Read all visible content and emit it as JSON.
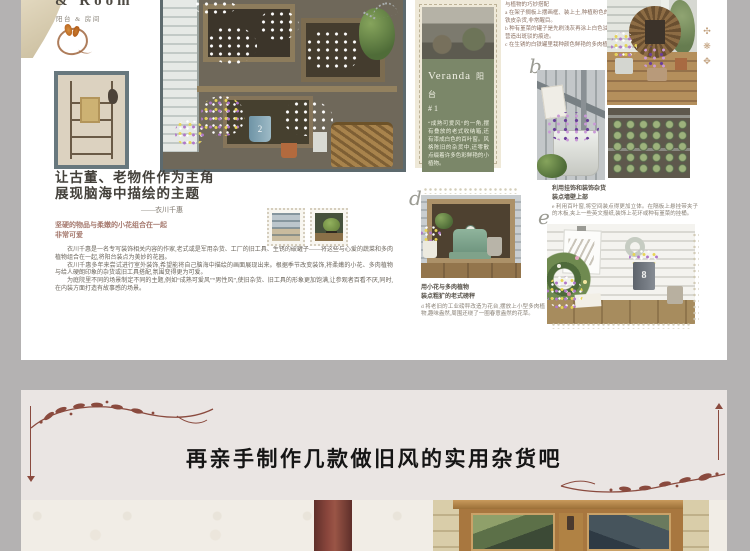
{
  "masthead": {
    "title_fragment": "& Room",
    "subtitle": "阳台 & 房间"
  },
  "article": {
    "title_line1": "让古董、老物件作为主角",
    "title_line2": "展现脑海中描绘的主题",
    "author": "——衣川千惠",
    "lead_line1": "坚硬的物品与柔嫩的小花组合在一起",
    "lead_line2": "非常可爱",
    "paragraphs": [
      "衣川千惠是一名专写装饰相关内容的作家,老式或是军用杂货、工厂的旧工具、生锈的破罐子——将这些与心爱的蔬菜和多肉植物组合在一起,将阳台装点为美妙的花园。",
      "衣川千惠多年来尝试进行室外装饰,希望能将自己脑海中描绘的画面展现出来。根据季节改变装饰,将柔嫩的小花、多肉植物与给人硬朗印象的杂货或旧工具搭配,氛围变得更为可爱。",
      "为庭院里不同的场景制定不同的主题,例如“成熟可爱风”“男性风”,使旧杂货、旧工具的形象更加饱满,让参观者百看不厌,同时,在内装方面打造有故事感的场景。"
    ]
  },
  "notes_top": {
    "lines": [
      "与植物的巧妙搭配",
      "a 在架子搁板上摆画框、装上土,种植粉色的堇菜和旧铁皮杂货,非常醒目。",
      "b 种有堇菜的罐子是先刷浅灰再涂上白色油漆的,有意营造出斑驳的痕迹。",
      "c 在生锈的白铁罐里栽种颜色鲜艳的多肉植物。"
    ]
  },
  "veranda_card": {
    "title_en": "Veranda",
    "title_cn": "阳 台",
    "number": "# 1",
    "body": "“成熟可爱风”的一角,摆有叠放的老式收纳箱,还有漆成白色的百叶窗。风格陈旧的杂货中,还零散点缀着许多色彩鲜艳的小植物。"
  },
  "letters": {
    "b": "b",
    "d": "d",
    "e": "e"
  },
  "main_photo": {
    "bucket_label": "2"
  },
  "section_d": {
    "heading_line1": "用小花与多肉植物",
    "heading_line2": "装点粗犷的老式磅秤",
    "note": "d 将老旧的工业磅秤改造为花台,摆放上小型多肉植物,趣味盎然,周围还绕了一圈春意盎然的花草。"
  },
  "section_e": {
    "heading_line1": "利用挂饰和装饰杂货",
    "heading_line2": "装点墙壁上部",
    "note": "e 利用百叶窗,将空间装点得更加立体。在隔板上悬挂带夹子的木板,夹上一些英文报纸,装饰上花环或种有堇菜的挂桶。",
    "planter_number": "8"
  },
  "decor": {
    "right_ornaments": [
      "✣",
      "❋",
      "✥"
    ]
  },
  "banner": {
    "title": "再亲手制作几款做旧风的实用杂货吧"
  },
  "colors": {
    "page_margin_gray": "#b4b2b2",
    "accent_maroon": "#8a4a3e",
    "card_green": "#7b8769",
    "banner_bg": "#eae5e3",
    "lead_text": "#a5786d"
  }
}
